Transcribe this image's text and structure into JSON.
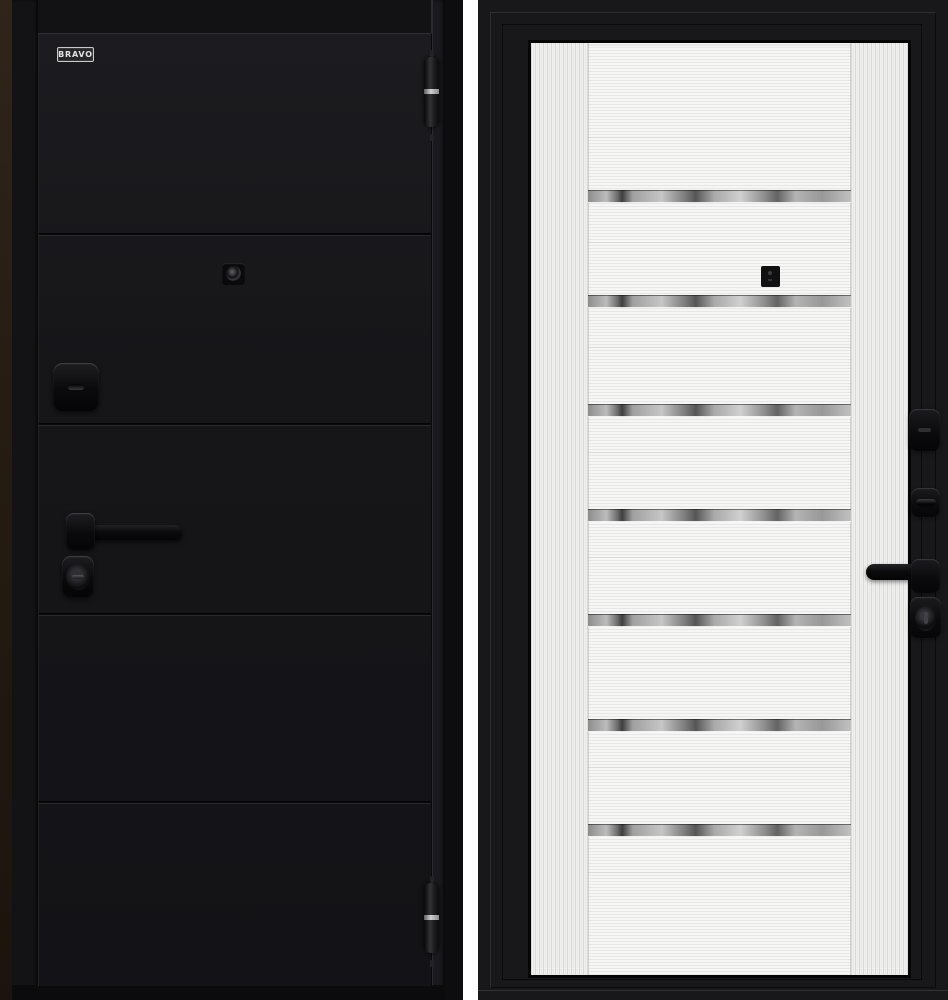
{
  "image": {
    "kind": "door-product-photo",
    "background_color": "#ffffff"
  },
  "brand": {
    "logo_text": "BRAVO"
  },
  "left_door": {
    "side": "exterior-black-panel",
    "leaf_color": "#17171b",
    "frame_edge_color": "#2c2117",
    "groove_lines_y": [
      232,
      422,
      612,
      800
    ],
    "hinges": [
      {
        "y": 57
      },
      {
        "y": 883
      }
    ],
    "hardware_icons": [
      "peephole-icon",
      "keyhole-escutcheon-icon",
      "lever-handle-icon",
      "cylinder-lock-icon"
    ]
  },
  "right_door": {
    "side": "interior-white-panel",
    "leaf_color": "#f3f3f1",
    "frame_color": "#18181a",
    "mirror_strip_color": "#a8a8a8",
    "mirror_strips_y": [
      187,
      292,
      401,
      506,
      611,
      716,
      821
    ],
    "hardware_icons": [
      "peephole-icon",
      "keyhole-escutcheon-icon",
      "thumbturn-icon",
      "lever-handle-icon",
      "cylinder-lock-icon"
    ]
  }
}
